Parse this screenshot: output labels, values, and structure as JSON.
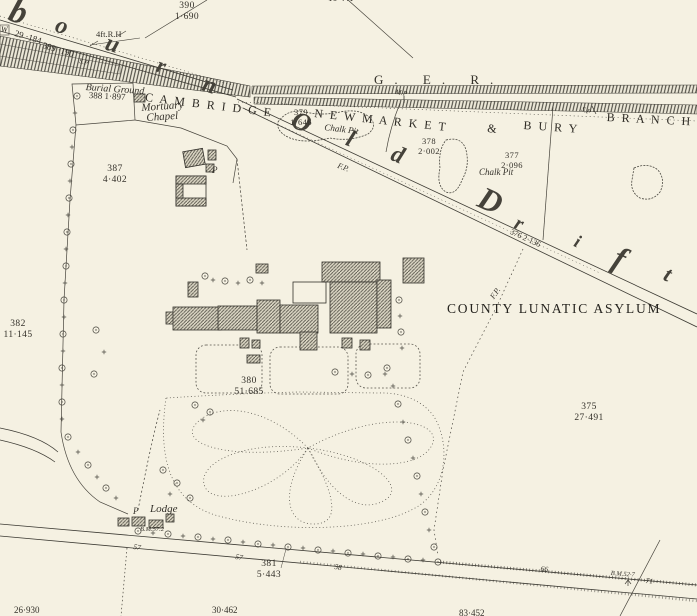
{
  "canvas": {
    "bg": "#f5f1e2",
    "ink": "#3a372f"
  },
  "title": "COUNTY LUNATIC ASYLUM",
  "railway": {
    "company": "G. E. R.",
    "name_part1": "C A M B R I D G E",
    "name_part2": "N E W M A R K E T",
    "name_amp": "&",
    "name_part3": "B U R Y",
    "name_part4": "B R A N C H",
    "mile_post": "M.P",
    "signal_post_1": "S.P",
    "signal_post_2": "S.P"
  },
  "script_letters": {
    "s1": "b",
    "s2": "o",
    "s3": "u",
    "s4": "r",
    "s5": "n",
    "o1": "O",
    "o2": "l",
    "o3": "d",
    "d1": "D",
    "d2": "r",
    "d3": "i",
    "d4": "f",
    "d5": "t"
  },
  "labels": {
    "burial_ground": "Burial Ground",
    "mortuary_1": "Mortuary",
    "mortuary_2": "Chapel",
    "chalk_pit_w": "Chalk Pit",
    "chalk_pit_e": "Chalk Pit",
    "lodge": "Lodge",
    "well": "W",
    "pump_n": "P",
    "pump_lodge": "P",
    "footpath_1": "F.P.",
    "footpath_2": "F.P.",
    "rail_height": "4ft.R.H"
  },
  "parcels": {
    "p390_no": "390",
    "p390_area": "1·690",
    "p29": "29 ·184",
    "p389": "389 ·190",
    "p388": "388  1·897",
    "p379_no": "379",
    "p379_area": "1·646",
    "p378_no": "378",
    "p378_area": "2·002",
    "p377_no": "377",
    "p377_area": "2·096",
    "p387_no": "387",
    "p387_area": "4·402",
    "p382_no": "382",
    "p382_area": "11·145",
    "p376_road": "376   2·136",
    "p380_no": "380",
    "p380_area": "51·685",
    "p375_no": "375",
    "p375_area": "27·491",
    "p381_no": "381",
    "p381_area": "5·443",
    "top_partial": "16·441",
    "bottom_sw": "26·930",
    "bottom_s": "30·462",
    "bottom_se": "83·452"
  },
  "benchmarks": {
    "lodge": "B.M.57.2",
    "road": "B.M.52·7"
  },
  "spot_levels": {
    "l1": "57",
    "l2": "57",
    "l3": "58",
    "l4": "66",
    "l5": "71"
  }
}
